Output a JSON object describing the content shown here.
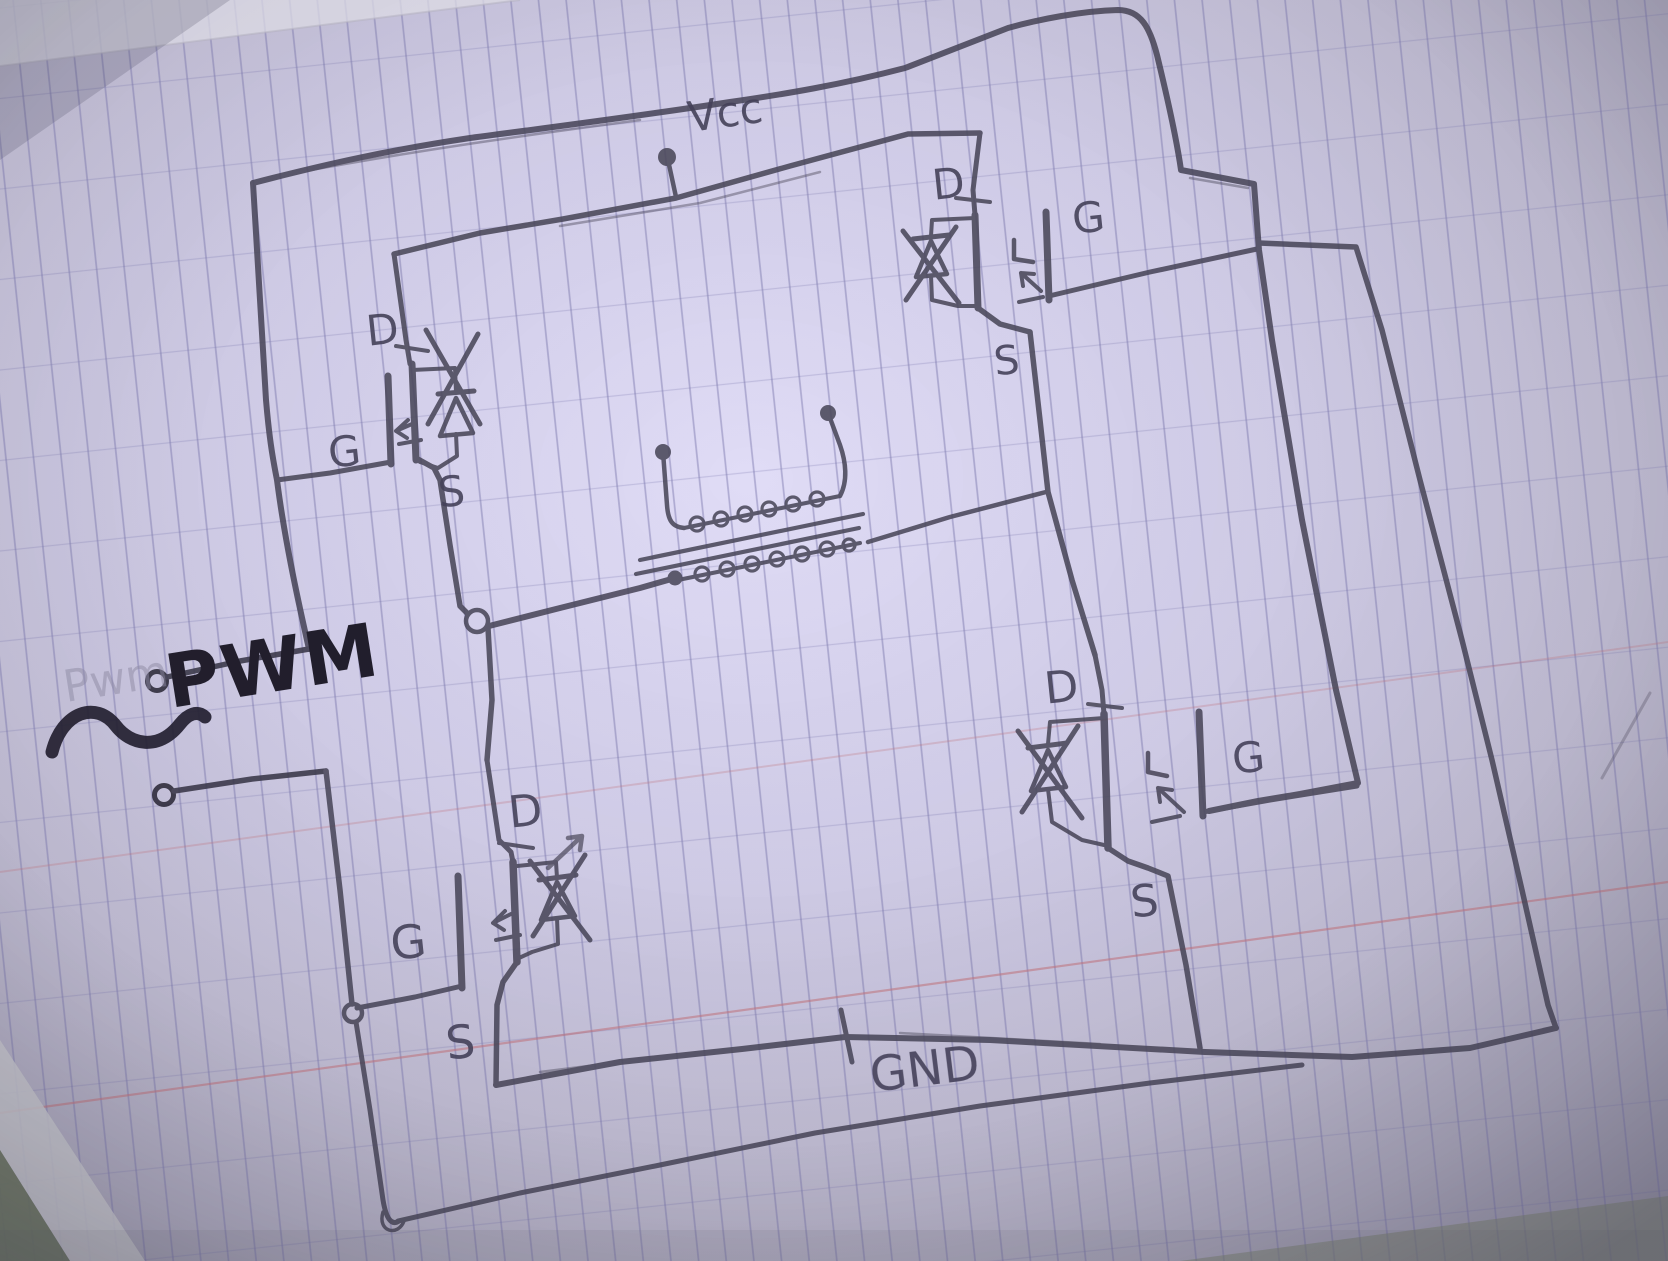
{
  "scene": {
    "description": "Hand-drawn H-bridge transformer driver circuit sketch in pencil on ruled notebook paper",
    "media": "pencil on ruled paper, photographed"
  },
  "power": {
    "vcc_label": "Vcc",
    "gnd_label": "GND"
  },
  "input": {
    "label": "PWM",
    "ghost_label": "Pwm",
    "waveform_symbol": "~"
  },
  "icons": {
    "ac_wave": "~",
    "junction_dot": "●",
    "open_terminal": "○"
  },
  "transistors": {
    "top_left": {
      "position": "top-left",
      "drain": "D",
      "gate": "G",
      "source": "S"
    },
    "top_right": {
      "position": "top-right",
      "drain": "D",
      "gate": "G",
      "source": "S"
    },
    "bottom_left": {
      "position": "bottom-left",
      "drain": "D",
      "gate": "G",
      "source": "S"
    },
    "bottom_right": {
      "position": "bottom-right",
      "drain": "D",
      "gate": "G",
      "source": "S"
    }
  },
  "components": {
    "transformer": "two-winding transformer with core lines",
    "mosfet_count": 4
  },
  "colors": {
    "pencil": "#4b485a",
    "marker_ink": "#232030",
    "paper_center": "#ddd9f2",
    "paper_edge": "#a09db0",
    "grid_line": "#7d7aaf",
    "rule_red": "#c4737c",
    "desk": "#6b755f"
  }
}
